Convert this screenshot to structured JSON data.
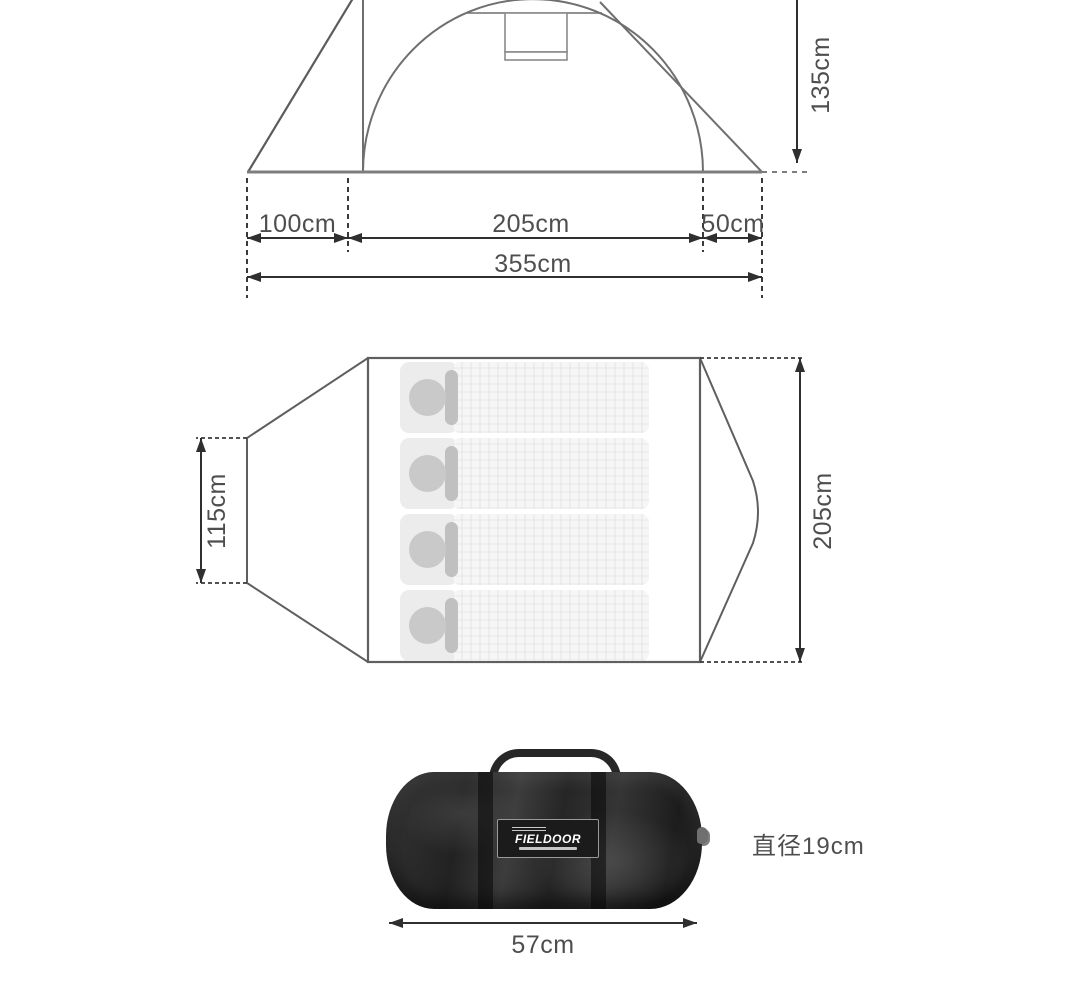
{
  "side_view": {
    "height_label": "135cm",
    "front_width_label": "100cm",
    "inner_width_label": "205cm",
    "rear_width_label": "50cm",
    "total_width_label": "355cm"
  },
  "floor_plan": {
    "vestibule_depth_label": "115cm",
    "inner_length_label": "205cm",
    "sleeping_bag_count": "4"
  },
  "carry_bag": {
    "brand_label": "FIELDOOR",
    "diameter_label": "直径19cm",
    "length_label": "57cm"
  },
  "colors": {
    "tent_outline": "#6f6f6f",
    "ground_line": "#7d7d7d",
    "dimension_line": "#2f2f2f",
    "label_text": "#4e4e4e",
    "bag_body": "#262626",
    "mat_fill": "#f6f6f6",
    "pillow_circle": "#c9c9c9"
  }
}
